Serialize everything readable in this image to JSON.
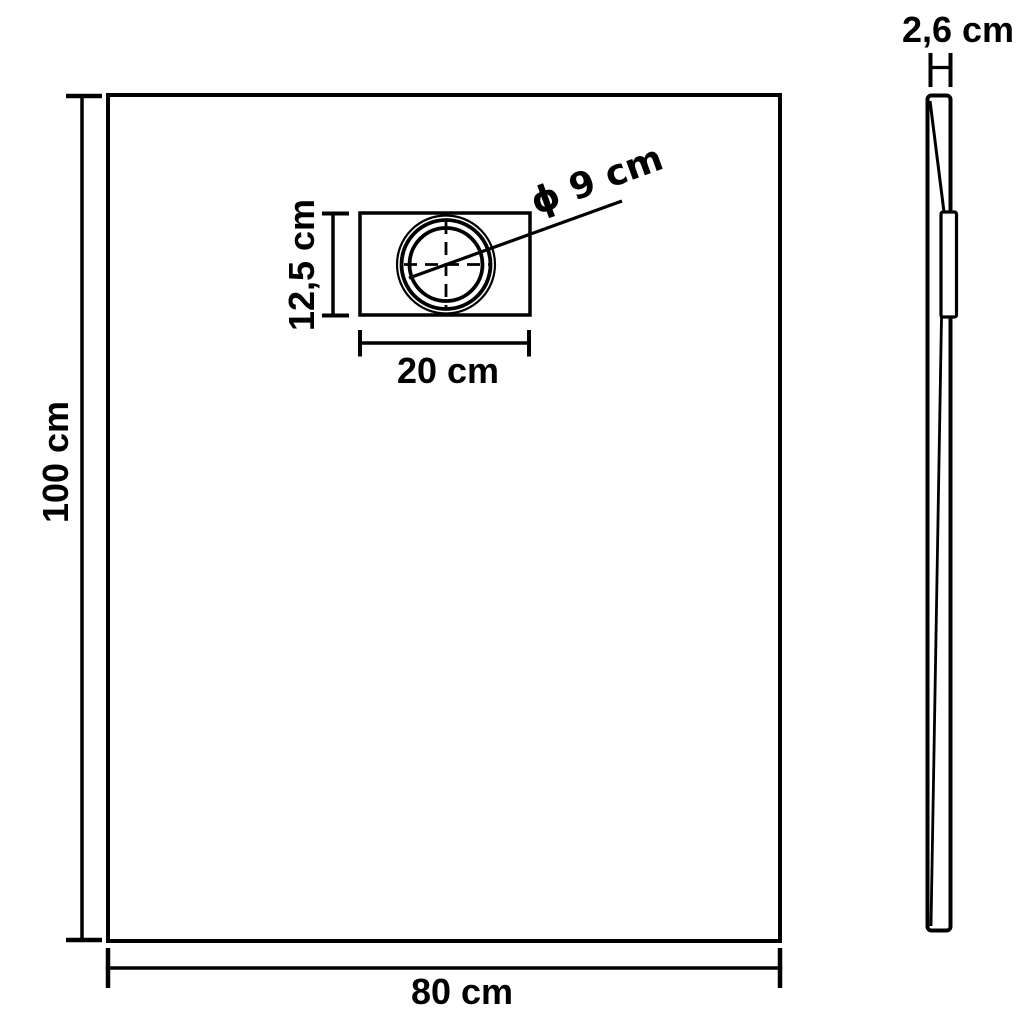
{
  "colors": {
    "line": "#000000",
    "background": "#ffffff"
  },
  "front_view": {
    "height_label": "100 cm",
    "width_label": "80 cm",
    "drain": {
      "height_label": "12,5 cm",
      "width_label": "20 cm",
      "diameter_label": "ϕ 9 cm"
    }
  },
  "side_view": {
    "thickness_label": "2,6 cm"
  }
}
